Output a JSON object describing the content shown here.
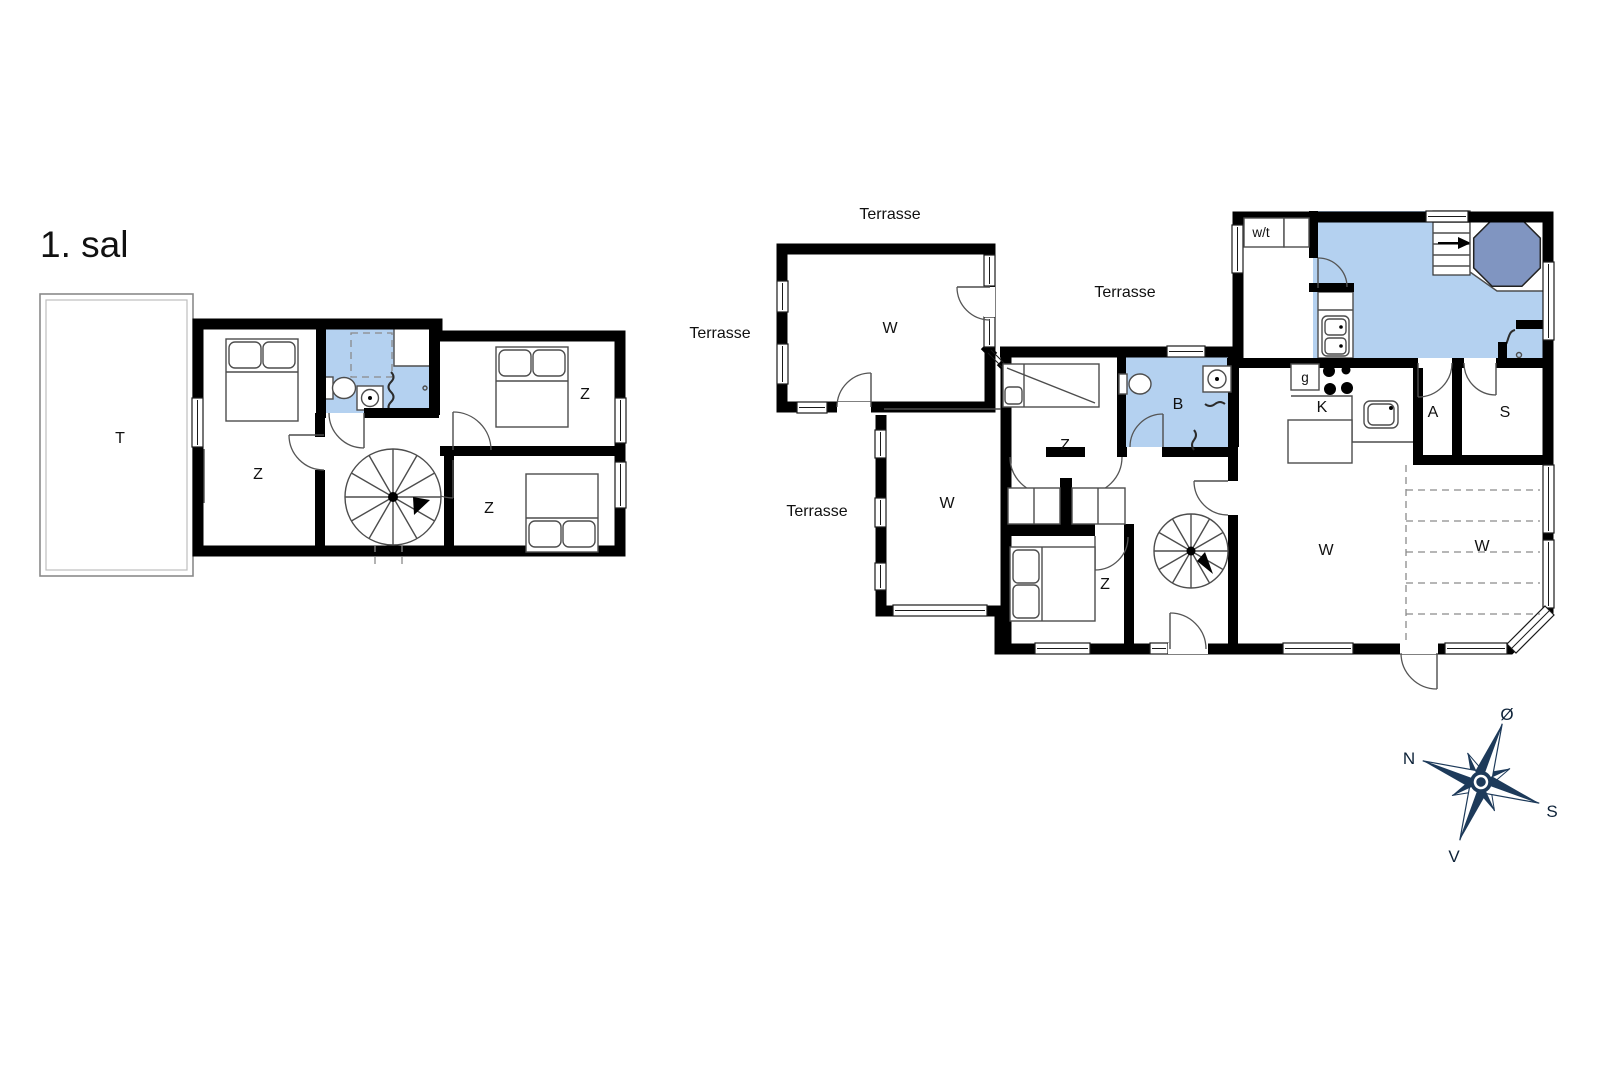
{
  "left_plan": {
    "title": "1. sal",
    "rooms": {
      "terrace": "T",
      "bedroom_nw": "Z",
      "bedroom_e": "Z",
      "bedroom_se": "Z"
    }
  },
  "right_plan": {
    "terraces": [
      "Terrasse",
      "Terrasse",
      "Terrasse",
      "Terrasse"
    ],
    "rooms": {
      "living_annex": "W",
      "living_west": "W",
      "bedroom_bunk": "Z",
      "bathroom": "B",
      "utility": "w/t",
      "stove": "g",
      "kitchen": "K",
      "anteroom": "A",
      "sauna": "S",
      "bedroom_s": "Z",
      "living_main": "W",
      "dining": "W"
    }
  },
  "compass": {
    "north": "N",
    "east": "Ø",
    "south": "S",
    "west": "V"
  },
  "colors": {
    "wall": "#000000",
    "bath_blue": "#b4d1f0",
    "hot_tub_blue": "#8095c1",
    "compass_navy": "#1d3a5a",
    "background": "#ffffff"
  }
}
